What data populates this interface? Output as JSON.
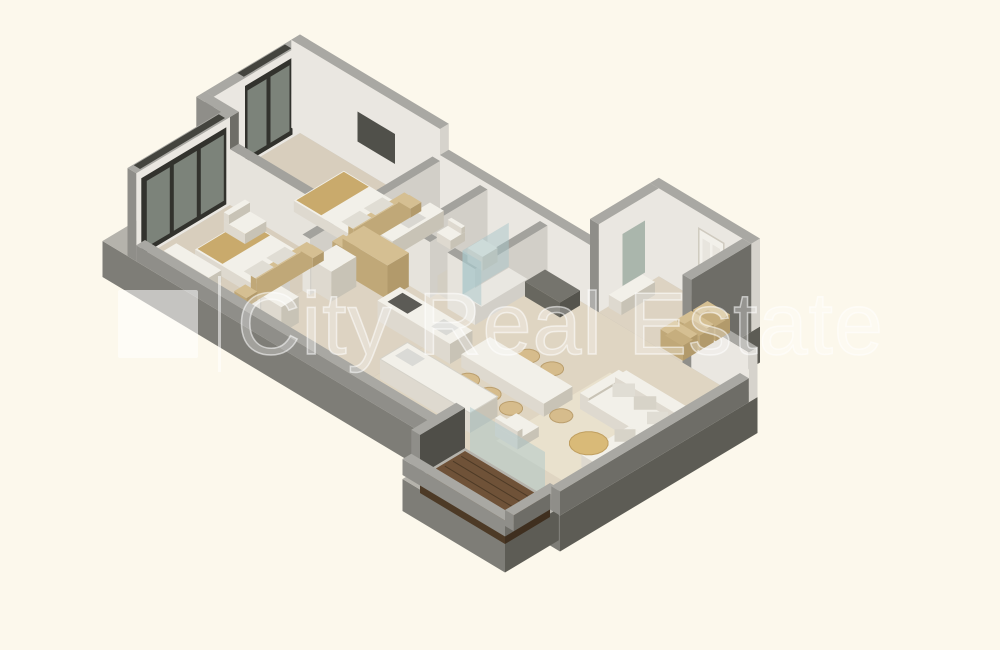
{
  "watermark": {
    "brand": "City Real Estate",
    "logo": "white-square-logo",
    "separator": "vertical-bar",
    "color": "#ffffff",
    "opacity": 0.5
  },
  "scene": {
    "type": "isometric-3d-floor-plan",
    "rooms": [
      "bedroom-2",
      "bedroom-1",
      "bathroom-1",
      "bathroom-2",
      "wardrobe",
      "corridor",
      "entrance-hall",
      "kitchen-dining",
      "living-room",
      "balcony"
    ],
    "furniture": [
      "double-bed",
      "nightstand",
      "armchair",
      "dresser",
      "tv",
      "window",
      "wardrobe-cabinet",
      "washer",
      "sink-counter",
      "toilet",
      "shower",
      "storage-cubbies",
      "entry-bench",
      "mirror",
      "console",
      "kitchen-counter",
      "kitchen-island",
      "dining-table",
      "dining-chair",
      "sofa",
      "pillow",
      "coffee-table",
      "rug",
      "balcony-deck",
      "entrance-door",
      "balcony-glass-door"
    ]
  },
  "palette": {
    "bg": "#fcf8ec",
    "slabTop": "#b5b3ac",
    "slabL": "#7e7d77",
    "slabD": "#5d5c55",
    "wallTop": "#a9a8a3",
    "wallFaceL": "#8f8e89",
    "wallFaceD": "#6e6d67",
    "innerWall": "#eae7e1",
    "innerWallShade": "#d6d3cc",
    "partitionTop": "#a3a29d",
    "partitionFaceL": "#e6e3dc",
    "partitionFaceR": "#d2cfc8",
    "floorBedroom": "#d8cebd",
    "floorBath": "#d3cec2",
    "floorHall": "#ddd3c2",
    "floorLiving": "#dfd5c2",
    "rug": "#e9e1cd",
    "balconyWood": "#6f5238",
    "balconyWoodD": "#4d3a26",
    "balconyWoodDark": "#3f2f1f",
    "balconyWallDark": "#4f4e48",
    "windowFrame": "#32322d",
    "windowFrameTop": "#44443e",
    "windowGlass": "#7c837a",
    "mirrorGlass": "#a3b0a6",
    "doorWhite": "#f2f0ea",
    "doorPanel": "#e8e5de",
    "doorFrame": "#cfcabf",
    "tvDark": "#50504a",
    "furnWhite": "#f2f0e9",
    "furnWhiteShade": "#ded9cf",
    "furnShadow": "#c8c3b6",
    "woodTan": "#d5bf92",
    "woodTanD": "#c0a878",
    "woodTanDark": "#b29a6b",
    "woodTanInner": "#c6ae7e",
    "beddingTan": "#c9aa6c",
    "pillowGray": "#e0ddd4",
    "pillowGray2": "#d7d3c8",
    "glassShower": "#a7c6c9",
    "tableGold": "#d9ba78",
    "tableGoldEdge": "#c09f60",
    "chairTan": "#d6bc8c",
    "chairTanD": "#bb9f6e",
    "basinGray": "#d9d7d1",
    "trayWhite": "#e9e7e1",
    "cooktopDark": "#5c5b56",
    "sinkGray": "#dadad6",
    "hallDark": "#75746d",
    "hallDarkL": "#68675f",
    "hallDarkD": "#55544d",
    "islandEdge": "#d5d2c9"
  }
}
